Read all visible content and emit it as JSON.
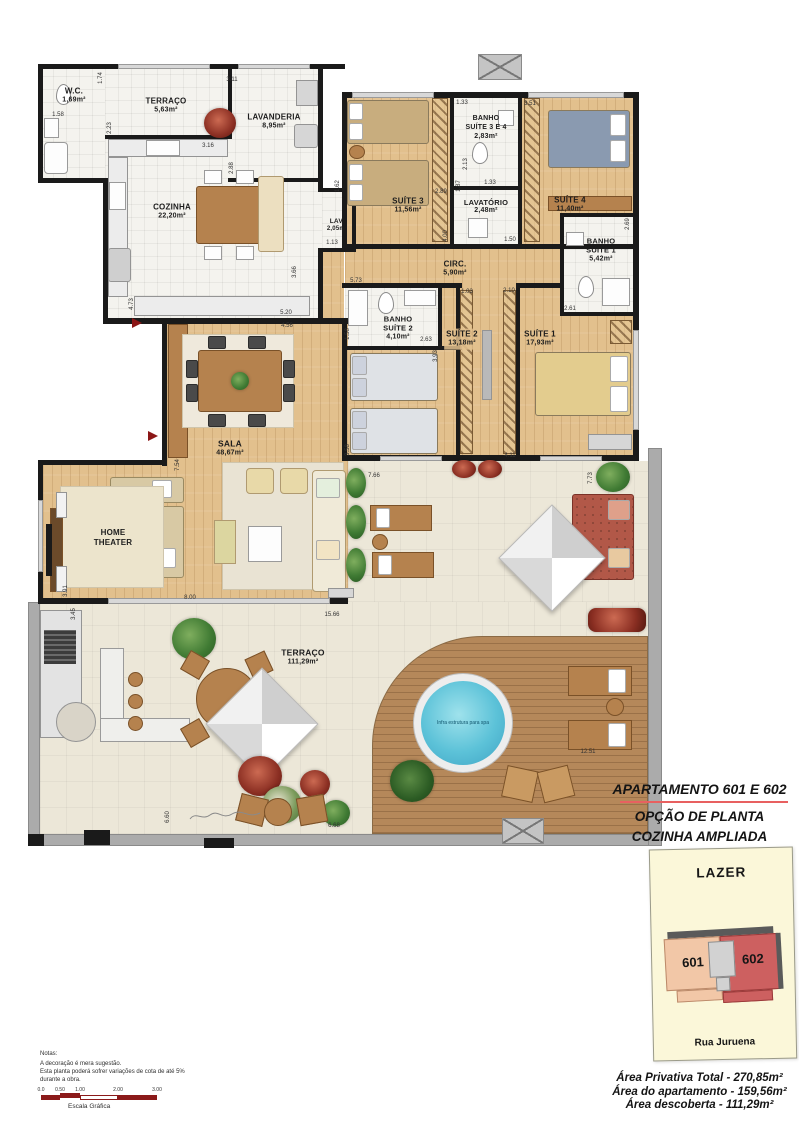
{
  "plan": {
    "rooms": [
      {
        "name": "W.C.",
        "area": "1,69m²"
      },
      {
        "name": "TERRAÇO",
        "area": "5,63m²"
      },
      {
        "name": "LAVANDERIA",
        "area": "8,95m²"
      },
      {
        "name": "COZINHA",
        "area": "22,20m²"
      },
      {
        "name": "LAV.",
        "area": "2,05m²"
      },
      {
        "name": "BANHO",
        "name2": "SUÍTE 3 E 4",
        "area": "2,83m²"
      },
      {
        "name": "SUÍTE 3",
        "area": "11,56m²"
      },
      {
        "name": "LAVATÓRIO",
        "area": "2,48m²"
      },
      {
        "name": "SUÍTE 4",
        "area": "11,40m²"
      },
      {
        "name": "BANHO",
        "name2": "SUÍTE 1",
        "area": "5,42m²"
      },
      {
        "name": "CIRC.",
        "area": "5,90m²"
      },
      {
        "name": "BANHO",
        "name2": "SUÍTE 2",
        "area": "4,10m²"
      },
      {
        "name": "SUÍTE 2",
        "area": "13,18m²"
      },
      {
        "name": "SUÍTE 1",
        "area": "17,93m²"
      },
      {
        "name": "SALA",
        "area": "48,67m²"
      },
      {
        "name": "HOME",
        "name2": "THEATER",
        "area": ""
      },
      {
        "name": "TERRAÇO",
        "area": "111,29m²"
      }
    ],
    "pool_label": "Infra estrutura para spa",
    "dims": [
      "1.58",
      "1.74",
      "2.23",
      "3.11",
      "3.16",
      "2.88",
      "1.62",
      "1.13",
      "1.33",
      "3.51",
      "2.13",
      "1.87",
      "1.33",
      "2.89",
      "4.00",
      "1.50",
      "2.69",
      "5.73",
      "1.03",
      "2.10",
      "2.61",
      "2.63",
      "3.93",
      "1.58",
      "3.58",
      "4.56",
      "5.20",
      "4.73",
      "3.66",
      "7.54",
      "3.91",
      "8.00",
      "3.45",
      "15.66",
      "7.66",
      "7.73",
      "4.11",
      "6.60",
      "6.68",
      "12.51"
    ]
  },
  "panel": {
    "title": "APARTAMENTO 601 E 602",
    "subtitle1": "OPÇÃO DE PLANTA",
    "subtitle2": "COZINHA AMPLIADA",
    "lazer": {
      "label": "LAZER",
      "unit_left": "601",
      "unit_right": "602",
      "street": "Rua Juruena"
    },
    "areas": [
      "Área Privativa Total - 270,85m²",
      "Área do apartamento - 159,56m²",
      "Área descoberta - 111,29m²"
    ]
  },
  "notes": {
    "heading": "Notas:",
    "line1": "A decoração é mera sugestão.",
    "line2": "Esta planta poderá sofrer variações de cota de até 5%",
    "line3": "durante a obra.",
    "scale_ticks": [
      "0.0",
      "0.50",
      "1.00",
      "2.00",
      "3.00"
    ],
    "scale_label": "Escala Gráfica"
  },
  "colors": {
    "wall": "#1a1a1a",
    "wood_floor": "#e2c08d",
    "tile_floor": "#f4f3ee",
    "terrace_floor": "#ece7d8",
    "deck": "#b5885a",
    "pool_water": "#55c0d8",
    "accent_red_line": "#e86060",
    "unit_601": "#f2c7a7",
    "unit_602": "#cd6060",
    "lazer_bg": "#fbf7d9",
    "scale_bar_red": "#8b1a1a"
  }
}
